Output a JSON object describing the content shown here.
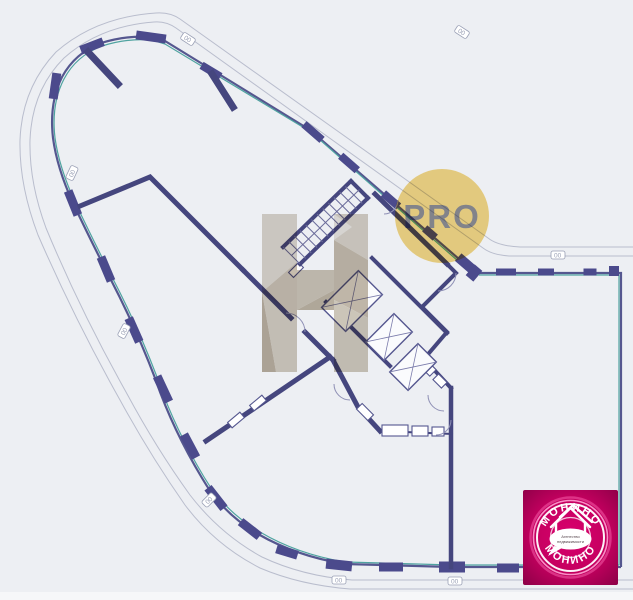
{
  "page": {
    "background_color": "#edeff3",
    "bottom_strip_color": "#f6f7f9"
  },
  "floor_plan": {
    "type": "architectural floor plan",
    "wall_color": "#45467e",
    "column_color": "#4b4a8c",
    "glass_color": "#4fa3a0",
    "contour_color": "#b9bdcd",
    "window_marker": "00"
  },
  "watermarks": {
    "pro_badge": {
      "label": "PRO",
      "circle_color": "#f4d57f",
      "text_color": "#8c8c91"
    },
    "h_logo": {
      "color": "#c9c0b0"
    },
    "agency_logo": {
      "name_top": "МОНИНО",
      "name_bottom": "МОНИНО",
      "tagline_line1": "Агентство",
      "tagline_line2": "недвижимости",
      "bg_color": "#c3005f",
      "ring_color": "#ff9ed2",
      "text_color": "#ffffff"
    }
  }
}
